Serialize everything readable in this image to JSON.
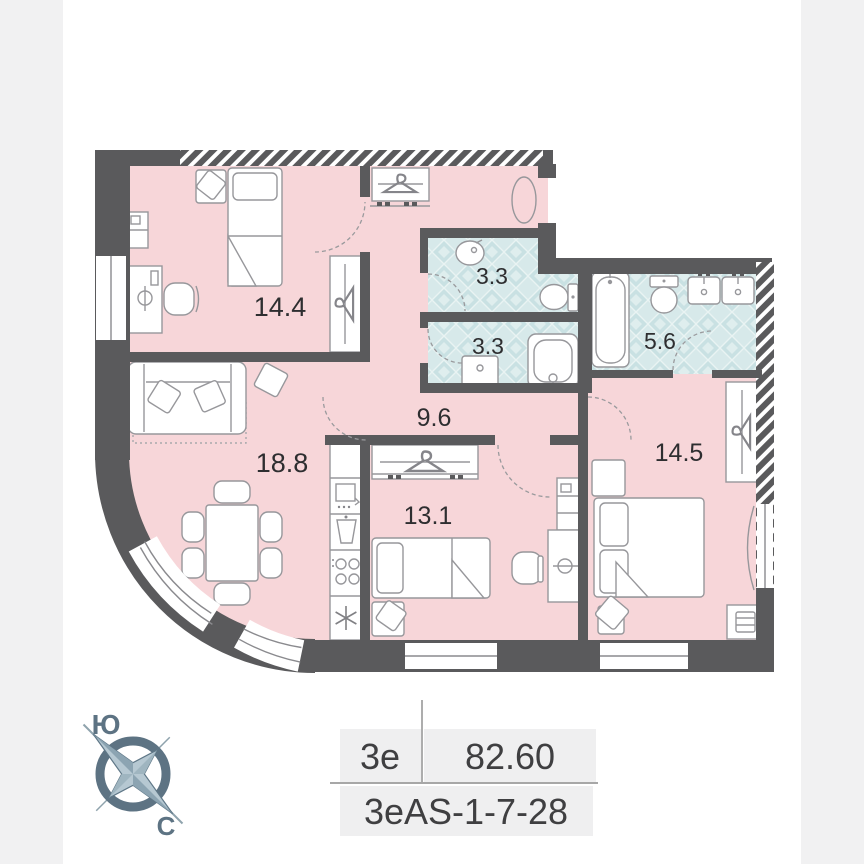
{
  "page": {
    "background": "#ffffff",
    "side_strip_color": "#f1f1f2"
  },
  "plan": {
    "colors": {
      "floor_pink": "#f7d6d9",
      "wall_dark": "#5a5a5c",
      "tile_blue": "#d7e9ea",
      "tile_diamond": "#c9e1e3",
      "furniture_stroke": "#97979b"
    },
    "rooms": [
      {
        "id": "bedroom-1",
        "area": "14.4"
      },
      {
        "id": "bathroom-top",
        "area": "3.3"
      },
      {
        "id": "bathroom-middle",
        "area": "3.3"
      },
      {
        "id": "bathroom-main",
        "area": "5.6"
      },
      {
        "id": "hallway",
        "area": "9.6"
      },
      {
        "id": "living-kitchen",
        "area": "18.8"
      },
      {
        "id": "bedroom-2",
        "area": "13.1"
      },
      {
        "id": "bedroom-3",
        "area": "14.5"
      }
    ],
    "icons": [
      "hanger-icon",
      "snowflake-fridge-icon",
      "cooktop-icon",
      "oven-icon",
      "kitchen-sink-icon",
      "bathtub-icon",
      "toilet-icon",
      "washbasin-icon",
      "shower-tray-icon",
      "bed-icon",
      "sofa-icon",
      "dining-table-icon",
      "desk-lamp-icon",
      "radiator-icon",
      "compass-rose-icon"
    ]
  },
  "compass": {
    "south_label": "Ю",
    "north_label": "С",
    "color": "#5d7383"
  },
  "info": {
    "plan_type": "3е",
    "total_area": "82.60",
    "unit_code": "3еAS-1-7-28"
  }
}
